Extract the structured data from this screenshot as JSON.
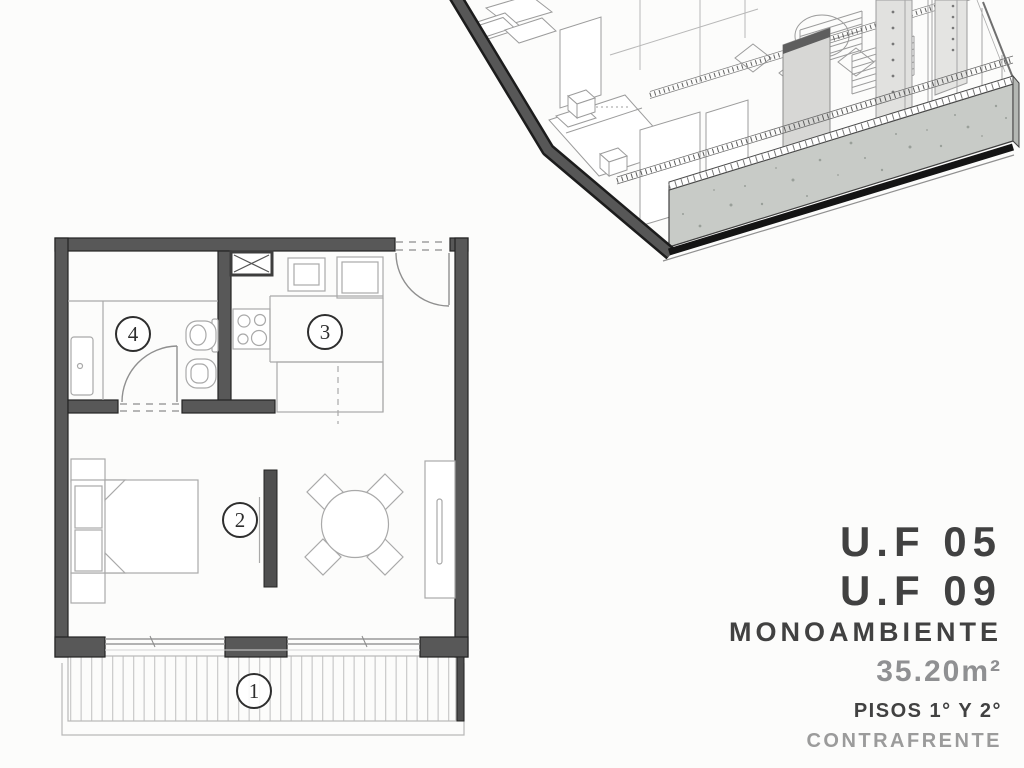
{
  "plan": {
    "rooms": [
      {
        "number": "1"
      },
      {
        "number": "2"
      },
      {
        "number": "3"
      },
      {
        "number": "4"
      }
    ]
  },
  "info_panel": {
    "unit_a": "U.F 05",
    "unit_b": "U.F 09",
    "type": "MONOAMBIENTE",
    "area": "35.20m²",
    "floors": "PISOS 1° Y 2°",
    "orientation": "CONTRAFRENTE"
  },
  "colors": {
    "wall_gray": "#585858",
    "divider_gray": "#4f4f4f",
    "concrete_gray": "#c8cbc7",
    "light_line": "#a9a9a9",
    "text_dark": "#414141",
    "text_muted": "#9b9b9b",
    "area_gray": "#8f9092",
    "background": "#fcfcfb"
  }
}
